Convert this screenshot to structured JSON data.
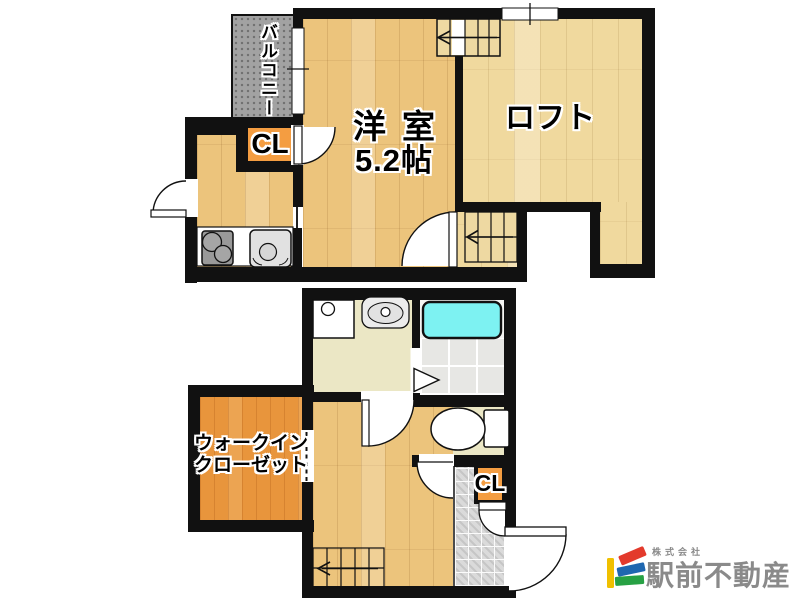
{
  "plans": {
    "floor_2f": {
      "balcony_label": "バルコニー",
      "closet_label": "CL",
      "room_name": "洋室",
      "room_size": "5.2帖",
      "loft_label": "ロフト"
    },
    "floor_1f": {
      "walk_in_closet_line1": "ウォークイン",
      "walk_in_closet_line2": "クローゼット",
      "closet_label": "CL"
    }
  },
  "logo": {
    "company_type": "株式会社",
    "company_name": "駅前不動産"
  },
  "palette": {
    "wall": "#111111",
    "wood_room": "#ecc47c",
    "wood_loft": "#f0d99e",
    "wood_wic": "#e8953c",
    "closet_orange": "#f49d41",
    "balcony_gray": "#a2a2a2",
    "sanitary_beige": "#ebe7c5",
    "bathtub_cyan": "#7df2f2",
    "bathroom_tile_gray": "#e7e7e4",
    "entrance_tile_gray": "#dadada",
    "logo_yellow": "#f0c000",
    "logo_red": "#e33a2c",
    "logo_blue": "#1f67b0",
    "logo_green": "#27a144",
    "logo_text_gray": "#8a8a8a"
  }
}
